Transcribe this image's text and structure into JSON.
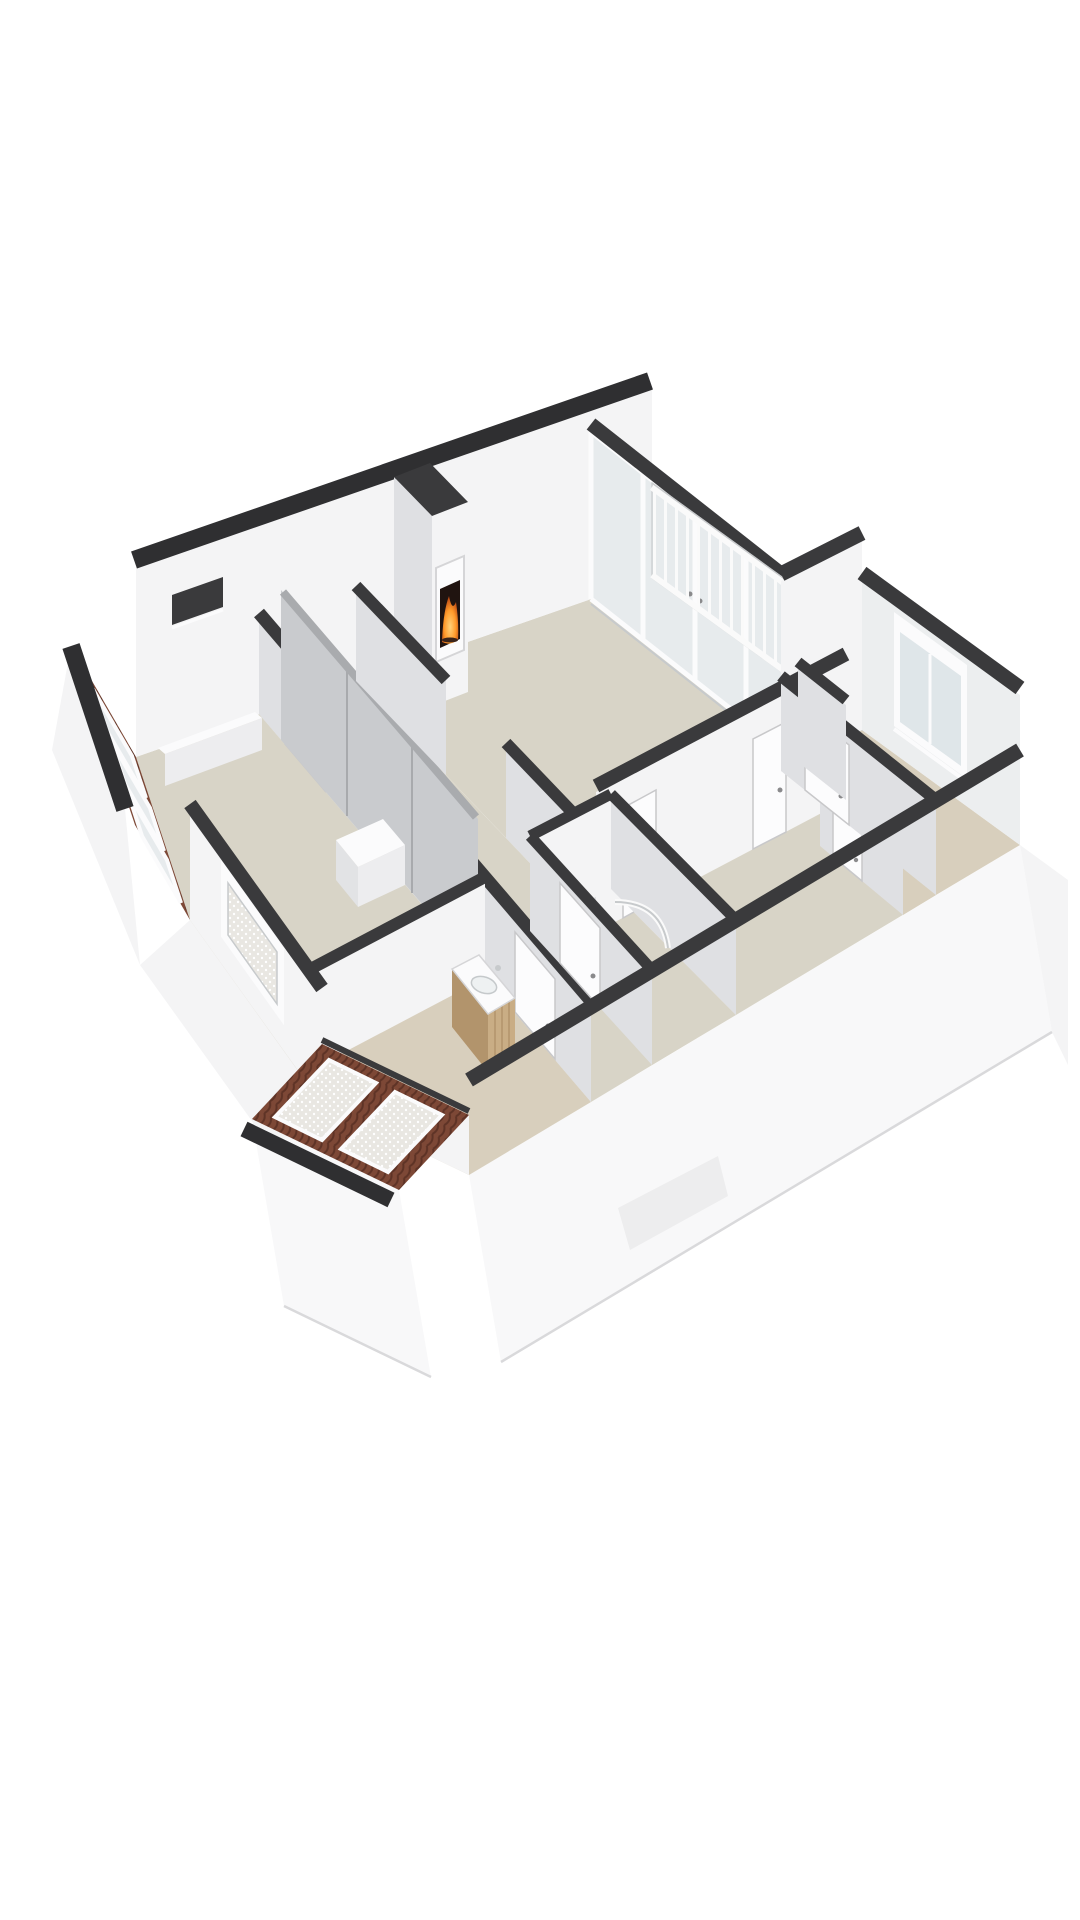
{
  "scene": {
    "kind": "3d-floorplan-cutaway-render",
    "description": "Isometric cutaway 3D floor plan of an attic-level apartment, viewed from the south-east, no labels or text visible",
    "background": "#ffffff"
  },
  "colors": {
    "wall_top": "#3a3a3c",
    "wall_outer": "#2f2f31",
    "wall_bright": "#f4f4f5",
    "wall_light": "#eceeef",
    "wall_shade": "#dfe0e3",
    "wall_deep": "#d2d3d6",
    "wall_exterior": "#f8f8f9",
    "apron_edge": "#d9d9db",
    "floor_main": "#d8d4c7",
    "floor_warm": "#d8cfbd",
    "floor_balcony": "#d5d2c8",
    "glass": "#e7ebed",
    "glass_deep": "#dfe6e9",
    "frame_white": "#fbfbfc",
    "frame_gray": "#c7cacc",
    "wardrobe": "#c9cbce",
    "wardrobe_seam": "#a8aaad",
    "wardrobe_top": "#a9abae",
    "roof_tile": "#7d4836",
    "roof_tile_dark": "#5e3326",
    "lace": "#e9e7e2",
    "wood": "#c9ad85",
    "wood_shade": "#b2946c",
    "fire_core": "#ffd27a",
    "fire_mid": "#ff9a2a",
    "fire_deep": "#b33f10",
    "firebox": "#201410",
    "log": "#3a241a",
    "railing": "#fafafa",
    "railing_edge": "#c9cbcd",
    "door": "#fcfcfd",
    "door_edge": "#c8c8ca",
    "handle": "#8a8a8c",
    "sink": "#eef1f2",
    "dormer_faint": "#ededee",
    "ledge": "#ededef",
    "ledge_side": "#e2e3e5",
    "ledge_top": "#fbfbfc"
  },
  "rooms": [
    {
      "id": "living-room",
      "floor": "floor_main",
      "features": [
        "fireplace",
        "glass-wall-to-balcony"
      ]
    },
    {
      "id": "balcony",
      "floor": "floor_balcony",
      "features": [
        "railing"
      ]
    },
    {
      "id": "bedroom-rear",
      "floor": "floor_warm",
      "features": [
        "window-in-end-wall"
      ]
    },
    {
      "id": "corridor",
      "floor": "floor_main",
      "features": [
        "doors"
      ]
    },
    {
      "id": "hallway",
      "floor": "floor_main",
      "features": [
        "doors"
      ]
    },
    {
      "id": "shower-room",
      "floor": "floor_main",
      "features": [
        "curved-shower-screen",
        "door"
      ]
    },
    {
      "id": "cupboard",
      "floor": "floor_warm",
      "features": [
        "door"
      ]
    },
    {
      "id": "bedroom-front",
      "floor": "floor_main",
      "features": [
        "sloped-roof-windows",
        "wardrobe",
        "low-ledges",
        "roof-slot-window"
      ]
    },
    {
      "id": "vanity-room",
      "floor": "floor_warm",
      "features": [
        "wooden-vanity-with-sink",
        "sloped-dormer-windows"
      ]
    }
  ],
  "features": {
    "fireplace_count": 1,
    "glass_wall_panels": 4,
    "balcony_railing_bar_spacing_px": 11,
    "roof_windows_nw_band": 3,
    "dormer_windows_se_band": 2,
    "gable_lace_window": 1,
    "rear_bedroom_window": 1,
    "interior_doors": 8,
    "wardrobe_seams": 2,
    "vanity_sink": 1,
    "shower_screen": 1
  }
}
